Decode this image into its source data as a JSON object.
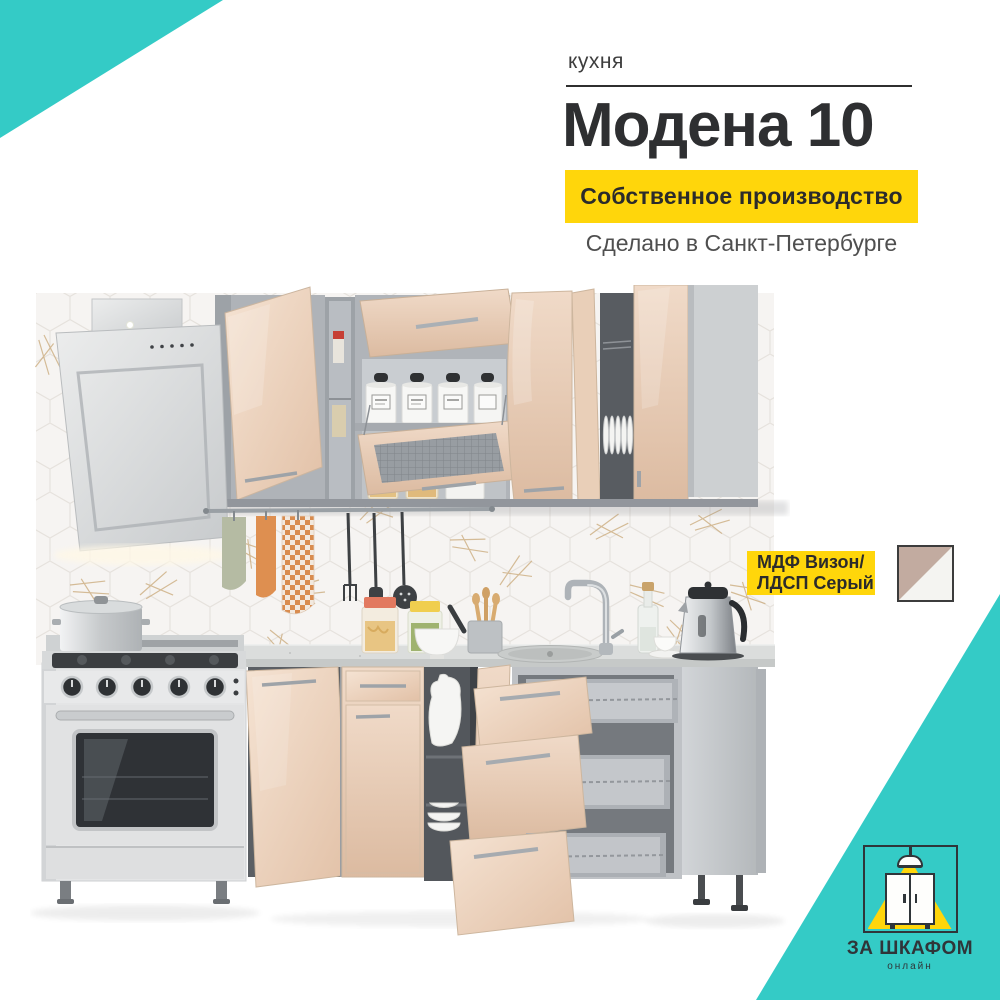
{
  "colors": {
    "teal": "#34CBC6",
    "yellow": "#FFD60B",
    "dark": "#2E2F31",
    "gray_text": "#4F4F4F",
    "badge_text": "#2B2B2B",
    "logo_dark": "#2F3539",
    "swatch_beige": "#C2ABA0",
    "swatch_white": "#F4F4F1",
    "vison_front": "#E7CBB2",
    "carcass_gray": "#B6BABF",
    "countertop_gray": "#DBDDDC"
  },
  "header": {
    "category": "кухня",
    "title": "Модена 10",
    "production_badge": "Собственное производство",
    "made_in": "Сделано в Санкт-Петербурге"
  },
  "material_badge": {
    "line1": "МДФ Визон/",
    "line2": "ЛДСП Серый"
  },
  "logo": {
    "name": "ЗА ШКАФОМ",
    "subname": "онлайн"
  }
}
